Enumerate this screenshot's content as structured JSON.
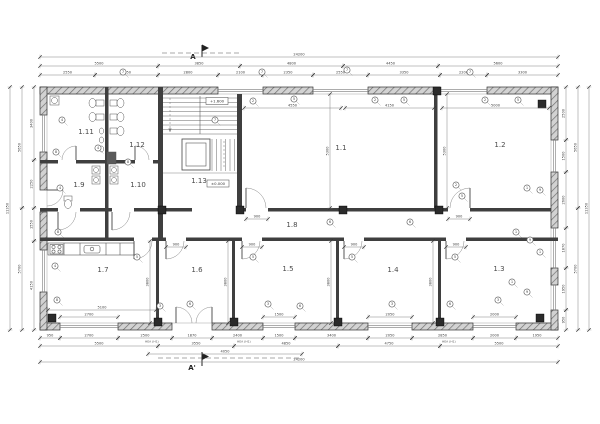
{
  "rooms": [
    {
      "label": "1.11",
      "cx": 86,
      "cy": 134
    },
    {
      "label": "1.12",
      "cx": 137,
      "cy": 147
    },
    {
      "label": "1.9",
      "cx": 79,
      "cy": 187
    },
    {
      "label": "1.10",
      "cx": 138,
      "cy": 187
    },
    {
      "label": "1.13",
      "cx": 199,
      "cy": 183
    },
    {
      "label": "1.1",
      "cx": 341,
      "cy": 150
    },
    {
      "label": "1.2",
      "cx": 500,
      "cy": 147
    },
    {
      "label": "1.8",
      "cx": 292,
      "cy": 227
    },
    {
      "label": "1.7",
      "cx": 103,
      "cy": 272
    },
    {
      "label": "1.6",
      "cx": 197,
      "cy": 272
    },
    {
      "label": "1.5",
      "cx": 288,
      "cy": 271
    },
    {
      "label": "1.4",
      "cx": 393,
      "cy": 272
    },
    {
      "label": "1.3",
      "cx": 499,
      "cy": 271
    }
  ],
  "sections": {
    "top": {
      "label": "A"
    },
    "bottom": {
      "label": "A'"
    }
  },
  "levels": [
    {
      "text": "+1.600"
    },
    {
      "text": "±0.000"
    }
  ],
  "dims": {
    "top": [
      {
        "x1": 40,
        "x2": 558,
        "y": 57,
        "t": "24200"
      },
      {
        "x1": 40,
        "x2": 158,
        "y": 66,
        "t": "5500"
      },
      {
        "x1": 158,
        "x2": 240,
        "y": 66,
        "t": "3850"
      },
      {
        "x1": 240,
        "x2": 343,
        "y": 66,
        "t": "4800"
      },
      {
        "x1": 343,
        "x2": 438,
        "y": 66,
        "t": "4450"
      },
      {
        "x1": 438,
        "x2": 558,
        "y": 66,
        "t": "5600"
      },
      {
        "x1": 40,
        "x2": 95,
        "y": 75,
        "t": "2550"
      },
      {
        "x1": 95,
        "x2": 158,
        "y": 75,
        "t": "2950"
      },
      {
        "x1": 158,
        "x2": 218,
        "y": 75,
        "t": "2800"
      },
      {
        "x1": 218,
        "x2": 263,
        "y": 75,
        "t": "2100"
      },
      {
        "x1": 263,
        "x2": 313,
        "y": 75,
        "t": "2350"
      },
      {
        "x1": 313,
        "x2": 368,
        "y": 75,
        "t": "2550"
      },
      {
        "x1": 368,
        "x2": 440,
        "y": 75,
        "t": "3350"
      },
      {
        "x1": 440,
        "x2": 487,
        "y": 75,
        "t": "2200"
      },
      {
        "x1": 487,
        "x2": 558,
        "y": 75,
        "t": "3300"
      }
    ],
    "bottom": [
      {
        "x1": 40,
        "x2": 60,
        "y": 338,
        "t": "950"
      },
      {
        "x1": 60,
        "x2": 118,
        "y": 338,
        "t": "2700"
      },
      {
        "x1": 118,
        "x2": 172,
        "y": 338,
        "t": "2500"
      },
      {
        "x1": 172,
        "x2": 212,
        "y": 338,
        "t": "1870"
      },
      {
        "x1": 212,
        "x2": 263,
        "y": 338,
        "t": "2400"
      },
      {
        "x1": 263,
        "x2": 295,
        "y": 338,
        "t": "1500"
      },
      {
        "x1": 295,
        "x2": 368,
        "y": 338,
        "t": "3400"
      },
      {
        "x1": 368,
        "x2": 412,
        "y": 338,
        "t": "2050"
      },
      {
        "x1": 412,
        "x2": 473,
        "y": 338,
        "t": "2850"
      },
      {
        "x1": 473,
        "x2": 516,
        "y": 338,
        "t": "2000"
      },
      {
        "x1": 516,
        "x2": 558,
        "y": 338,
        "t": "1950"
      },
      {
        "x1": 40,
        "x2": 158,
        "y": 346,
        "t": "5500"
      },
      {
        "x1": 158,
        "x2": 234,
        "y": 346,
        "t": "3550"
      },
      {
        "x1": 234,
        "x2": 338,
        "y": 346,
        "t": "4850"
      },
      {
        "x1": 338,
        "x2": 440,
        "y": 346,
        "t": "4750"
      },
      {
        "x1": 440,
        "x2": 558,
        "y": 346,
        "t": "5500"
      },
      {
        "x1": 148,
        "x2": 302,
        "y": 354,
        "t": "4050"
      },
      {
        "x1": 40,
        "x2": 558,
        "y": 362,
        "t": "24200"
      }
    ],
    "left": [
      {
        "y1": 87,
        "y2": 160,
        "x": 34,
        "t": "3400"
      },
      {
        "y1": 160,
        "y2": 208,
        "x": 34,
        "t": "2250"
      },
      {
        "y1": 208,
        "y2": 241,
        "x": 34,
        "t": "1550"
      },
      {
        "y1": 241,
        "y2": 330,
        "x": 34,
        "t": "4150"
      },
      {
        "y1": 87,
        "y2": 208,
        "x": 22,
        "t": "5650"
      },
      {
        "y1": 208,
        "y2": 330,
        "x": 22,
        "t": "5700"
      },
      {
        "y1": 87,
        "y2": 330,
        "x": 10,
        "t": "11350"
      }
    ],
    "right": [
      {
        "y1": 87,
        "y2": 140,
        "x": 566,
        "t": "2500"
      },
      {
        "y1": 140,
        "y2": 172,
        "x": 566,
        "t": "1500"
      },
      {
        "y1": 172,
        "y2": 228,
        "x": 566,
        "t": "2600"
      },
      {
        "y1": 228,
        "y2": 268,
        "x": 566,
        "t": "1870"
      },
      {
        "y1": 268,
        "y2": 310,
        "x": 566,
        "t": "1950"
      },
      {
        "y1": 310,
        "y2": 330,
        "x": 566,
        "t": "950"
      },
      {
        "y1": 87,
        "y2": 208,
        "x": 578,
        "t": "5650"
      },
      {
        "y1": 208,
        "y2": 330,
        "x": 578,
        "t": "5700"
      },
      {
        "y1": 87,
        "y2": 330,
        "x": 589,
        "t": "11350"
      }
    ],
    "inner": [
      {
        "x1": 244,
        "x2": 341,
        "y": 108,
        "t": "4550"
      },
      {
        "x1": 345,
        "x2": 434,
        "y": 108,
        "t": "4150"
      },
      {
        "x1": 442,
        "x2": 549,
        "y": 108,
        "t": "5000"
      },
      {
        "x1": 246,
        "x2": 268,
        "y": 219,
        "t": "900"
      },
      {
        "x1": 448,
        "x2": 470,
        "y": 219,
        "t": "900"
      },
      {
        "x1": 60,
        "x2": 118,
        "y": 317,
        "t": "2700"
      },
      {
        "x1": 263,
        "x2": 295,
        "y": 317,
        "t": "1500"
      },
      {
        "x1": 368,
        "x2": 412,
        "y": 317,
        "t": "2050"
      },
      {
        "x1": 473,
        "x2": 516,
        "y": 317,
        "t": "2000"
      },
      {
        "x1": 48,
        "x2": 156,
        "y": 310,
        "t": "5100"
      },
      {
        "y1": 241,
        "y2": 323,
        "x": 150,
        "t": "3800",
        "v": true
      },
      {
        "y1": 241,
        "y2": 323,
        "x": 228,
        "t": "3800",
        "v": true
      },
      {
        "y1": 241,
        "y2": 323,
        "x": 331,
        "t": "3800",
        "v": true
      },
      {
        "y1": 241,
        "y2": 323,
        "x": 433,
        "t": "3800",
        "v": true
      },
      {
        "y1": 94,
        "y2": 208,
        "x": 330,
        "t": "5300",
        "v": true
      },
      {
        "y1": 94,
        "y2": 208,
        "x": 447,
        "t": "5300",
        "v": true
      },
      {
        "x1": 166,
        "x2": 186,
        "y": 247,
        "t": "900"
      },
      {
        "x1": 242,
        "x2": 262,
        "y": 247,
        "t": "900"
      },
      {
        "x1": 344,
        "x2": 364,
        "y": 247,
        "t": "900"
      },
      {
        "x1": 446,
        "x2": 466,
        "y": 247,
        "t": "900"
      }
    ],
    "sublabels": [
      {
        "x": 145,
        "y": 342.5,
        "t": "HEA (H1)"
      },
      {
        "x": 237,
        "y": 342.5,
        "t": "HEA (H1)"
      },
      {
        "x": 442,
        "y": 342.5,
        "t": "HEA (H1)"
      }
    ]
  },
  "keynotes": [
    {
      "x": 253,
      "y": 101,
      "n": "2"
    },
    {
      "x": 294,
      "y": 99,
      "n": "5"
    },
    {
      "x": 375,
      "y": 100,
      "n": "2"
    },
    {
      "x": 404,
      "y": 100,
      "n": "5"
    },
    {
      "x": 485,
      "y": 100,
      "n": "2"
    },
    {
      "x": 518,
      "y": 100,
      "n": "5"
    },
    {
      "x": 123,
      "y": 72,
      "n": "7"
    },
    {
      "x": 262,
      "y": 72,
      "n": "7"
    },
    {
      "x": 347,
      "y": 70,
      "n": "7"
    },
    {
      "x": 470,
      "y": 72,
      "n": "7"
    },
    {
      "x": 160,
      "y": 306,
      "n": "3"
    },
    {
      "x": 190,
      "y": 304,
      "n": "6"
    },
    {
      "x": 268,
      "y": 304,
      "n": "3"
    },
    {
      "x": 300,
      "y": 306,
      "n": "6"
    },
    {
      "x": 392,
      "y": 304,
      "n": "3"
    },
    {
      "x": 450,
      "y": 304,
      "n": "6"
    },
    {
      "x": 498,
      "y": 300,
      "n": "3"
    },
    {
      "x": 62,
      "y": 120,
      "n": "4"
    },
    {
      "x": 56,
      "y": 152,
      "n": "8"
    },
    {
      "x": 60,
      "y": 188,
      "n": "4"
    },
    {
      "x": 58,
      "y": 232,
      "n": "8"
    },
    {
      "x": 55,
      "y": 266,
      "n": "4"
    },
    {
      "x": 57,
      "y": 300,
      "n": "8"
    },
    {
      "x": 527,
      "y": 188,
      "n": "1"
    },
    {
      "x": 540,
      "y": 190,
      "n": "9"
    },
    {
      "x": 516,
      "y": 232,
      "n": "1"
    },
    {
      "x": 530,
      "y": 240,
      "n": "9"
    },
    {
      "x": 540,
      "y": 252,
      "n": "1"
    },
    {
      "x": 527,
      "y": 292,
      "n": "9"
    },
    {
      "x": 512,
      "y": 282,
      "n": "1"
    },
    {
      "x": 137,
      "y": 257,
      "n": "5"
    },
    {
      "x": 253,
      "y": 257,
      "n": "5"
    },
    {
      "x": 352,
      "y": 257,
      "n": "5"
    },
    {
      "x": 455,
      "y": 257,
      "n": "5"
    },
    {
      "x": 330,
      "y": 222,
      "n": "6"
    },
    {
      "x": 410,
      "y": 222,
      "n": "6"
    },
    {
      "x": 98,
      "y": 148,
      "n": "4"
    },
    {
      "x": 128,
      "y": 162,
      "n": "8"
    },
    {
      "x": 215,
      "y": 120,
      "n": "7"
    },
    {
      "x": 456,
      "y": 185,
      "n": "2"
    },
    {
      "x": 462,
      "y": 196,
      "n": "5"
    }
  ],
  "colors": {
    "wall": "#3f3f3f",
    "hatch_bg": "#d2d2d2",
    "hatch_line": "#707070",
    "line": "#555555",
    "dim": "#3c3c3c",
    "background": "#ffffff"
  }
}
